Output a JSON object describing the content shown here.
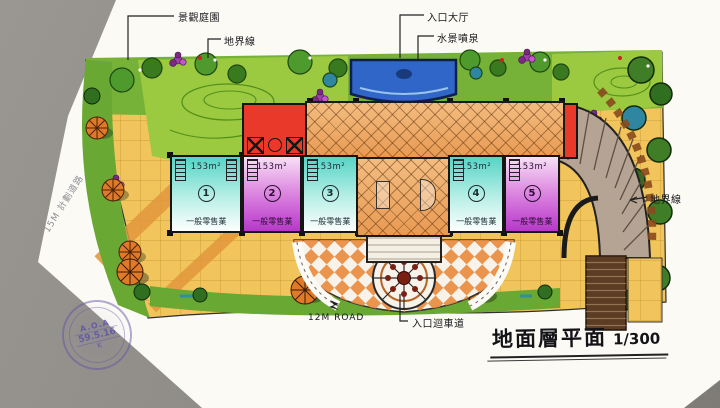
{
  "title": {
    "text": "地面層平面",
    "scale": "1/300"
  },
  "annotations": {
    "landscape_garden": "景觀庭園",
    "boundary_line_top": "地界線",
    "entrance_hall": "入口大厅",
    "water_feature": "水景噴泉",
    "boundary_line_right": "地界線",
    "road_12m": "12M ROAD",
    "entrance_driveway": "入口迴車道",
    "road_15m": "15M 計劃道路"
  },
  "units": [
    {
      "number": "1",
      "area": "153m²",
      "use": "一般零售業"
    },
    {
      "number": "2",
      "area": "153m²",
      "use": "一般零售業"
    },
    {
      "number": "3",
      "area": "153m²",
      "use": "一般零售業"
    },
    {
      "number": "4",
      "area": "153m²",
      "use": "一般零售業"
    },
    {
      "number": "5",
      "area": "153m²",
      "use": "一般零售業"
    }
  ],
  "stamp": {
    "line1": "A.O.A",
    "line2": "59.5.16",
    "line3": "K"
  },
  "colors": {
    "background": "#8d8a85",
    "paper": "#fbfaf5",
    "paving": "#f1c55b",
    "lawn": "#7ab33a",
    "water": "#2f66c8",
    "retail_cyan": "#56d4c6",
    "retail_magenta": "#b937cc",
    "core_red": "#e8392a",
    "hall_orange": "#e89a52",
    "ramp_brown": "#b5a393"
  }
}
